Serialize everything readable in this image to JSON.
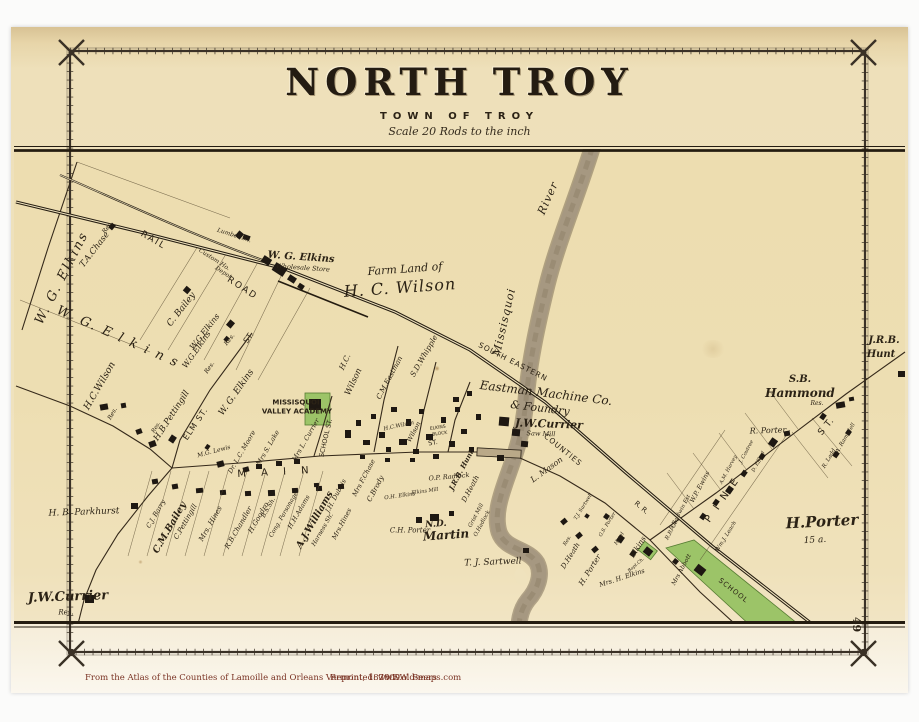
{
  "title": {
    "main": "NORTH TROY",
    "sub": "TOWN OF TROY",
    "scale": "Scale 20 Rods to the inch"
  },
  "page": {
    "number": "49"
  },
  "footer": {
    "source": "From the Atlas of the Counties of Lamoille and Orleans Vermont,  1878    F.W. Beers",
    "reprinted": "Reprinted: 2009",
    "website": "www.old-maps.com"
  },
  "colors": {
    "paper": "#efe2bd",
    "ink": "#2b2215",
    "river": "#a69881",
    "green_parcel": "#9cc468",
    "caption": "#7a3324"
  },
  "map_labels": [
    {
      "t": "W. G. Elkins",
      "x": 62,
      "y": 278,
      "r": -63,
      "s": 13,
      "f": "i",
      "ls": 2
    },
    {
      "t": "T.A.Chase",
      "x": 95,
      "y": 250,
      "r": -52,
      "s": 8.5,
      "f": "i"
    },
    {
      "t": "Res.",
      "x": 108,
      "y": 228,
      "r": -52,
      "s": 6,
      "f": "i"
    },
    {
      "t": "RAIL",
      "x": 153,
      "y": 241,
      "r": 30,
      "s": 9,
      "f": "s",
      "ls": 2
    },
    {
      "t": "ROAD",
      "x": 242,
      "y": 289,
      "r": 33,
      "s": 9,
      "f": "s",
      "ls": 2
    },
    {
      "t": "Lumber Sh.",
      "x": 234,
      "y": 236,
      "r": 18,
      "s": 6,
      "f": "i"
    },
    {
      "t": "Custom Ho.",
      "x": 214,
      "y": 260,
      "r": 33,
      "s": 6,
      "f": "i"
    },
    {
      "t": "Depot",
      "x": 223,
      "y": 273,
      "r": 33,
      "s": 6,
      "f": "i"
    },
    {
      "t": "W. G. Elkins",
      "x": 301,
      "y": 258,
      "r": 4,
      "s": 10,
      "f": "bi"
    },
    {
      "t": "Wholesale Store",
      "x": 303,
      "y": 268,
      "r": 4,
      "s": 6.5,
      "f": "i"
    },
    {
      "t": "C. Bailey",
      "x": 182,
      "y": 310,
      "r": -52,
      "s": 9,
      "f": "i"
    },
    {
      "t": "W.G.Elkins",
      "x": 205,
      "y": 332,
      "r": -52,
      "s": 8,
      "f": "i"
    },
    {
      "t": "Res.",
      "x": 230,
      "y": 340,
      "r": -52,
      "s": 6,
      "f": "i"
    },
    {
      "t": "Farm Land of",
      "x": 405,
      "y": 269,
      "r": -4,
      "s": 11,
      "f": "i"
    },
    {
      "t": "H. C. Wilson",
      "x": 400,
      "y": 288,
      "r": -4,
      "s": 16,
      "f": "i",
      "ls": 1
    },
    {
      "t": "W. G. E l k i n s",
      "x": 118,
      "y": 337,
      "r": 24,
      "s": 13,
      "f": "i",
      "ls": 2
    },
    {
      "t": "H.C.Wilson",
      "x": 100,
      "y": 386,
      "r": -60,
      "s": 9.5,
      "f": "i"
    },
    {
      "t": "Res.",
      "x": 113,
      "y": 414,
      "r": -60,
      "s": 6,
      "f": "i"
    },
    {
      "t": "W.G.Elkins",
      "x": 197,
      "y": 350,
      "r": -55,
      "s": 8,
      "f": "i"
    },
    {
      "t": "Res.",
      "x": 210,
      "y": 368,
      "r": -55,
      "s": 6,
      "f": "i"
    },
    {
      "t": "W. G. Elkins",
      "x": 237,
      "y": 393,
      "r": -55,
      "s": 9,
      "f": "i"
    },
    {
      "t": "ELM  ST.",
      "x": 196,
      "y": 424,
      "r": -56,
      "s": 8,
      "f": "s",
      "ls": 1
    },
    {
      "t": "ST.",
      "x": 249,
      "y": 338,
      "r": -56,
      "s": 8,
      "f": "s"
    },
    {
      "t": "H.B.Pettingill",
      "x": 172,
      "y": 416,
      "r": -57,
      "s": 8.5,
      "f": "i"
    },
    {
      "t": "Res.",
      "x": 157,
      "y": 428,
      "r": -57,
      "s": 5.5,
      "f": "i"
    },
    {
      "t": "M.G. Lewis",
      "x": 214,
      "y": 452,
      "r": -15,
      "s": 6,
      "f": "i"
    },
    {
      "t": "Dr. L.C. Moore",
      "x": 242,
      "y": 452,
      "r": -60,
      "s": 6.5,
      "f": "i"
    },
    {
      "t": "Mrs S. Lake",
      "x": 268,
      "y": 448,
      "r": -60,
      "s": 6.5,
      "f": "i"
    },
    {
      "t": "Mrs L. Currier",
      "x": 306,
      "y": 440,
      "r": -60,
      "s": 6.5,
      "f": "i"
    },
    {
      "t": "River",
      "x": 548,
      "y": 198,
      "r": -66,
      "s": 11,
      "f": "i",
      "ls": 1
    },
    {
      "t": "Missisquoi",
      "x": 504,
      "y": 322,
      "r": -77,
      "s": 11,
      "f": "i",
      "ls": 1
    },
    {
      "t": "SOUTH EASTERN",
      "x": 513,
      "y": 362,
      "r": 27,
      "s": 7.5,
      "f": "s",
      "ls": 1
    },
    {
      "t": "COUNTIES",
      "x": 563,
      "y": 450,
      "r": 39,
      "s": 7.5,
      "f": "s",
      "ls": 1
    },
    {
      "t": "R. R.",
      "x": 641,
      "y": 508,
      "r": 40,
      "s": 7,
      "f": "s"
    },
    {
      "t": "Eastman Machine Co.",
      "x": 546,
      "y": 393,
      "r": 7,
      "s": 12,
      "f": "i"
    },
    {
      "t": "& Foundry",
      "x": 540,
      "y": 408,
      "r": 7,
      "s": 11,
      "f": "i"
    },
    {
      "t": "J.W.Currier",
      "x": 549,
      "y": 424,
      "r": 2,
      "s": 11,
      "f": "bi"
    },
    {
      "t": "Saw Mill",
      "x": 541,
      "y": 434,
      "r": 2,
      "s": 6.5,
      "f": "i"
    },
    {
      "t": "L. Mason",
      "x": 547,
      "y": 470,
      "r": -36,
      "s": 8,
      "f": "i"
    },
    {
      "t": "H.C.",
      "x": 345,
      "y": 362,
      "r": -65,
      "s": 7.5,
      "f": "i"
    },
    {
      "t": "Wilson",
      "x": 354,
      "y": 382,
      "r": -65,
      "s": 8.5,
      "f": "i"
    },
    {
      "t": "C.M.Eastman",
      "x": 390,
      "y": 378,
      "r": -62,
      "s": 7,
      "f": "i"
    },
    {
      "t": "S.D.Whipple",
      "x": 424,
      "y": 356,
      "r": -60,
      "s": 7.5,
      "f": "i"
    },
    {
      "t": "SCHOOL ST.",
      "x": 326,
      "y": 438,
      "r": -77,
      "s": 6.5,
      "f": "s"
    },
    {
      "t": "MISSISQUOI",
      "x": 296,
      "y": 403,
      "r": 0,
      "s": 7,
      "f": "sb"
    },
    {
      "t": "VALLEY ACADEMY",
      "x": 297,
      "y": 412,
      "r": 0,
      "s": 7,
      "f": "sb"
    },
    {
      "t": "M A I N",
      "x": 276,
      "y": 473,
      "r": -3,
      "s": 10,
      "f": "s",
      "ls": 6
    },
    {
      "t": "H.C.Wilson",
      "x": 399,
      "y": 427,
      "r": -12,
      "s": 5.5,
      "f": "i"
    },
    {
      "t": "Wilson",
      "x": 414,
      "y": 432,
      "r": -62,
      "s": 6.5,
      "f": "i"
    },
    {
      "t": "ELKINS",
      "x": 438,
      "y": 429,
      "r": -8,
      "s": 4.5,
      "f": "s"
    },
    {
      "t": "BLOCK",
      "x": 440,
      "y": 435,
      "r": -8,
      "s": 4.5,
      "f": "s"
    },
    {
      "t": "ST.",
      "x": 433,
      "y": 443,
      "r": -10,
      "s": 6.5,
      "f": "s"
    },
    {
      "t": "C.J. Barry",
      "x": 156,
      "y": 514,
      "r": -60,
      "s": 6.5,
      "f": "i"
    },
    {
      "t": "C.M.Bailey",
      "x": 170,
      "y": 528,
      "r": -60,
      "s": 9.5,
      "f": "bi"
    },
    {
      "t": "C.Pettingill",
      "x": 186,
      "y": 522,
      "r": -60,
      "s": 7,
      "f": "i"
    },
    {
      "t": "Mrs. Hines",
      "x": 211,
      "y": 524,
      "r": -60,
      "s": 7,
      "f": "i"
    },
    {
      "t": "R.B.Chandler",
      "x": 239,
      "y": 528,
      "r": -60,
      "s": 7,
      "f": "i"
    },
    {
      "t": "H.Goodro",
      "x": 259,
      "y": 518,
      "r": -60,
      "s": 7,
      "f": "i"
    },
    {
      "t": "B.S.Sh.",
      "x": 269,
      "y": 508,
      "r": -60,
      "s": 6,
      "f": "i"
    },
    {
      "t": "Cong. Parsonage",
      "x": 284,
      "y": 515,
      "r": -60,
      "s": 6,
      "f": "i"
    },
    {
      "t": "H.H.Adams",
      "x": 299,
      "y": 512,
      "r": -60,
      "s": 6.5,
      "f": "i"
    },
    {
      "t": "A.J.Williams",
      "x": 315,
      "y": 520,
      "r": -60,
      "s": 9.5,
      "f": "bi"
    },
    {
      "t": "Harness Sh.",
      "x": 323,
      "y": 530,
      "r": -60,
      "s": 6,
      "f": "i"
    },
    {
      "t": "J.H. Dubois",
      "x": 336,
      "y": 496,
      "r": -62,
      "s": 6.5,
      "f": "i"
    },
    {
      "t": "Mrs.Hines",
      "x": 342,
      "y": 524,
      "r": -62,
      "s": 6.5,
      "f": "i"
    },
    {
      "t": "Mrs F.Chase",
      "x": 364,
      "y": 478,
      "r": -62,
      "s": 6.5,
      "f": "i"
    },
    {
      "t": "C.Brody",
      "x": 376,
      "y": 489,
      "r": -62,
      "s": 7,
      "f": "i"
    },
    {
      "t": "O.H. Elkins",
      "x": 400,
      "y": 497,
      "r": -8,
      "s": 5.5,
      "f": "i"
    },
    {
      "t": "Elkins Mill",
      "x": 425,
      "y": 492,
      "r": -8,
      "s": 5,
      "f": "i"
    },
    {
      "t": "O.P. Radlock",
      "x": 449,
      "y": 477,
      "r": -5,
      "s": 6.5,
      "f": "i"
    },
    {
      "t": "J.R.B. Hunt",
      "x": 461,
      "y": 470,
      "r": -62,
      "s": 7,
      "f": "bi"
    },
    {
      "t": "D.Heath",
      "x": 471,
      "y": 489,
      "r": -62,
      "s": 7,
      "f": "i"
    },
    {
      "t": "Grist Mill",
      "x": 477,
      "y": 516,
      "r": -62,
      "s": 5.5,
      "f": "i"
    },
    {
      "t": "O.Hadlock",
      "x": 483,
      "y": 524,
      "r": -62,
      "s": 5.5,
      "f": "i"
    },
    {
      "t": "C.H. Porter",
      "x": 410,
      "y": 531,
      "r": 0,
      "s": 7,
      "f": "i"
    },
    {
      "t": "N.D.",
      "x": 436,
      "y": 525,
      "r": -4,
      "s": 9,
      "f": "bi"
    },
    {
      "t": "Martin",
      "x": 446,
      "y": 535,
      "r": -4,
      "s": 12,
      "f": "bi"
    },
    {
      "t": "T. J. Sartwell",
      "x": 493,
      "y": 563,
      "r": -2,
      "s": 9,
      "f": "i"
    },
    {
      "t": "T.J. Sartwell",
      "x": 584,
      "y": 507,
      "r": -58,
      "s": 5,
      "f": "i"
    },
    {
      "t": "G.S. Porter",
      "x": 608,
      "y": 525,
      "r": -58,
      "s": 5,
      "f": "i"
    },
    {
      "t": "Res.",
      "x": 568,
      "y": 541,
      "r": -58,
      "s": 5,
      "f": "i"
    },
    {
      "t": "D.Heath",
      "x": 571,
      "y": 556,
      "r": -58,
      "s": 7,
      "f": "i"
    },
    {
      "t": "H. Porter",
      "x": 590,
      "y": 570,
      "r": -58,
      "s": 7.5,
      "f": "i"
    },
    {
      "t": "Mrs. H. Elkins",
      "x": 622,
      "y": 578,
      "r": -18,
      "s": 6.5,
      "f": "i"
    },
    {
      "t": "Hotel",
      "x": 620,
      "y": 539,
      "r": -58,
      "s": 5,
      "f": "i"
    },
    {
      "t": "Elkins",
      "x": 638,
      "y": 547,
      "r": -58,
      "s": 7.5,
      "f": "i"
    },
    {
      "t": "Bapt.Ch.",
      "x": 637,
      "y": 566,
      "r": -40,
      "s": 4.5,
      "f": "i"
    },
    {
      "t": "Mrs Abbott",
      "x": 682,
      "y": 570,
      "r": -62,
      "s": 6,
      "f": "i"
    },
    {
      "t": "SCHOOL",
      "x": 733,
      "y": 591,
      "r": 38,
      "s": 7,
      "f": "s",
      "ls": 1
    },
    {
      "t": "W.P. Ewins",
      "x": 700,
      "y": 487,
      "r": -62,
      "s": 6.5,
      "f": "i"
    },
    {
      "t": "B.Baldwin Est",
      "x": 681,
      "y": 513,
      "r": -62,
      "s": 5.5,
      "f": "i"
    },
    {
      "t": "R.R. Co.",
      "x": 673,
      "y": 530,
      "r": -62,
      "s": 5.5,
      "f": "i"
    },
    {
      "t": "Wm.J. Leach",
      "x": 727,
      "y": 537,
      "r": -58,
      "s": 5.5,
      "f": "i"
    },
    {
      "t": "P I N E",
      "x": 723,
      "y": 500,
      "r": -55,
      "s": 10,
      "f": "s",
      "ls": 3
    },
    {
      "t": "S T.",
      "x": 827,
      "y": 427,
      "r": -50,
      "s": 9,
      "f": "s",
      "ls": 1
    },
    {
      "t": "R. Porter",
      "x": 768,
      "y": 431,
      "r": -2,
      "s": 8,
      "f": "i"
    },
    {
      "t": "J. Coutree",
      "x": 747,
      "y": 452,
      "r": -62,
      "s": 5,
      "f": "i"
    },
    {
      "t": "D. Efford",
      "x": 759,
      "y": 462,
      "r": -62,
      "s": 5,
      "f": "i"
    },
    {
      "t": "A.M. Harvey",
      "x": 729,
      "y": 470,
      "r": -62,
      "s": 5,
      "f": "i"
    },
    {
      "t": "C.A. Ramsdell",
      "x": 845,
      "y": 441,
      "r": -60,
      "s": 5.5,
      "f": "i"
    },
    {
      "t": "R. Ladd",
      "x": 830,
      "y": 459,
      "r": -60,
      "s": 5.5,
      "f": "i"
    },
    {
      "t": "H.Porter",
      "x": 822,
      "y": 522,
      "r": -3,
      "s": 15,
      "f": "bi"
    },
    {
      "t": "15 a.",
      "x": 815,
      "y": 541,
      "r": -3,
      "s": 9,
      "f": "i"
    },
    {
      "t": "S.B.",
      "x": 800,
      "y": 380,
      "r": 0,
      "s": 10,
      "f": "bi"
    },
    {
      "t": "Hammond",
      "x": 800,
      "y": 393,
      "r": 0,
      "s": 12,
      "f": "bi"
    },
    {
      "t": "Res.",
      "x": 817,
      "y": 404,
      "r": 0,
      "s": 6,
      "f": "i"
    },
    {
      "t": "J.R.B.",
      "x": 884,
      "y": 341,
      "r": 0,
      "s": 10,
      "f": "bi"
    },
    {
      "t": "Hunt",
      "x": 881,
      "y": 355,
      "r": 0,
      "s": 10,
      "f": "bi"
    },
    {
      "t": "H. B. Parkhurst",
      "x": 84,
      "y": 513,
      "r": -2,
      "s": 9,
      "f": "i"
    },
    {
      "t": "J.W.Currier",
      "x": 68,
      "y": 597,
      "r": -2,
      "s": 13,
      "f": "bi"
    },
    {
      "t": "Res.",
      "x": 66,
      "y": 613,
      "r": 0,
      "s": 7,
      "f": "i"
    }
  ]
}
